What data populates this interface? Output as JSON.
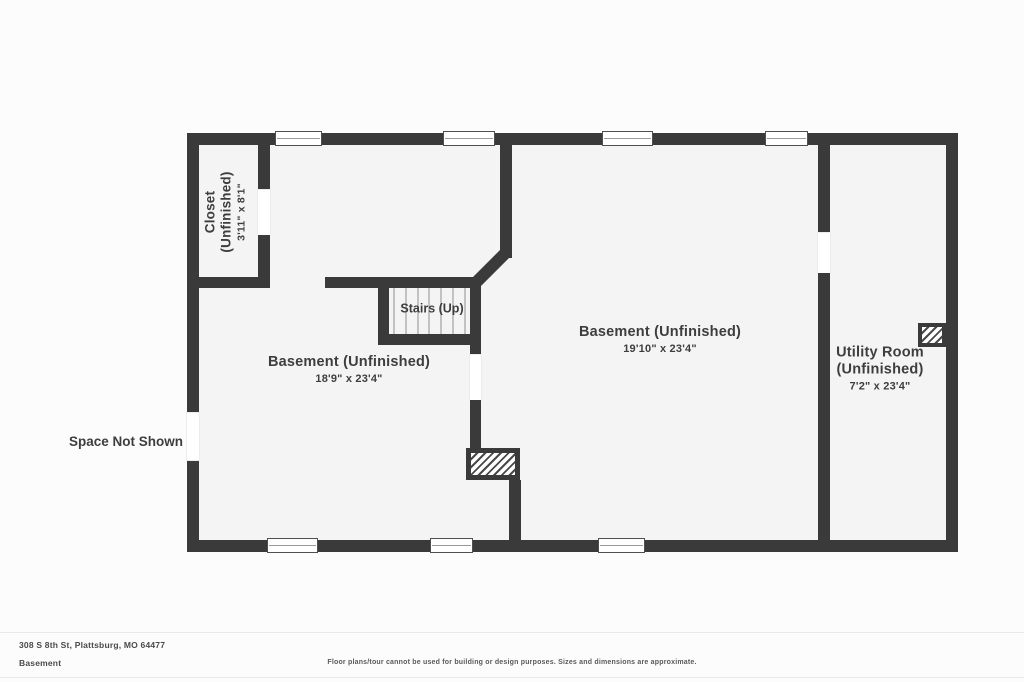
{
  "meta": {
    "address": "308 S 8th St, Plattsburg, MO 64477",
    "floor_label": "Basement",
    "disclaimer": "Floor plans/tour cannot be used for building or design purposes. Sizes and dimensions are approximate."
  },
  "rooms": {
    "closet": {
      "name": "Closet",
      "status": "(Unfinished)",
      "dims": "3'11\" x 8'1\""
    },
    "basement_left": {
      "name": "Basement (Unfinished)",
      "dims": "18'9\" x 23'4\""
    },
    "basement_main": {
      "name": "Basement (Unfinished)",
      "dims": "19'10\" x 23'4\""
    },
    "utility": {
      "name": "Utility Room",
      "status": "(Unfinished)",
      "dims": "7'2\" x 23'4\""
    },
    "stairs": {
      "label": "Stairs (Up)"
    }
  },
  "annotations": {
    "space_not_shown": "Space Not Shown"
  },
  "colors": {
    "wall": "#3a3a3a",
    "room_fill": "#f4f4f4",
    "background": "#fcfcfc",
    "tread": "#c2c2c2",
    "text": "#3e3e3e",
    "window_frame": "#4f4f4f",
    "divider": "#e9e9e9"
  }
}
